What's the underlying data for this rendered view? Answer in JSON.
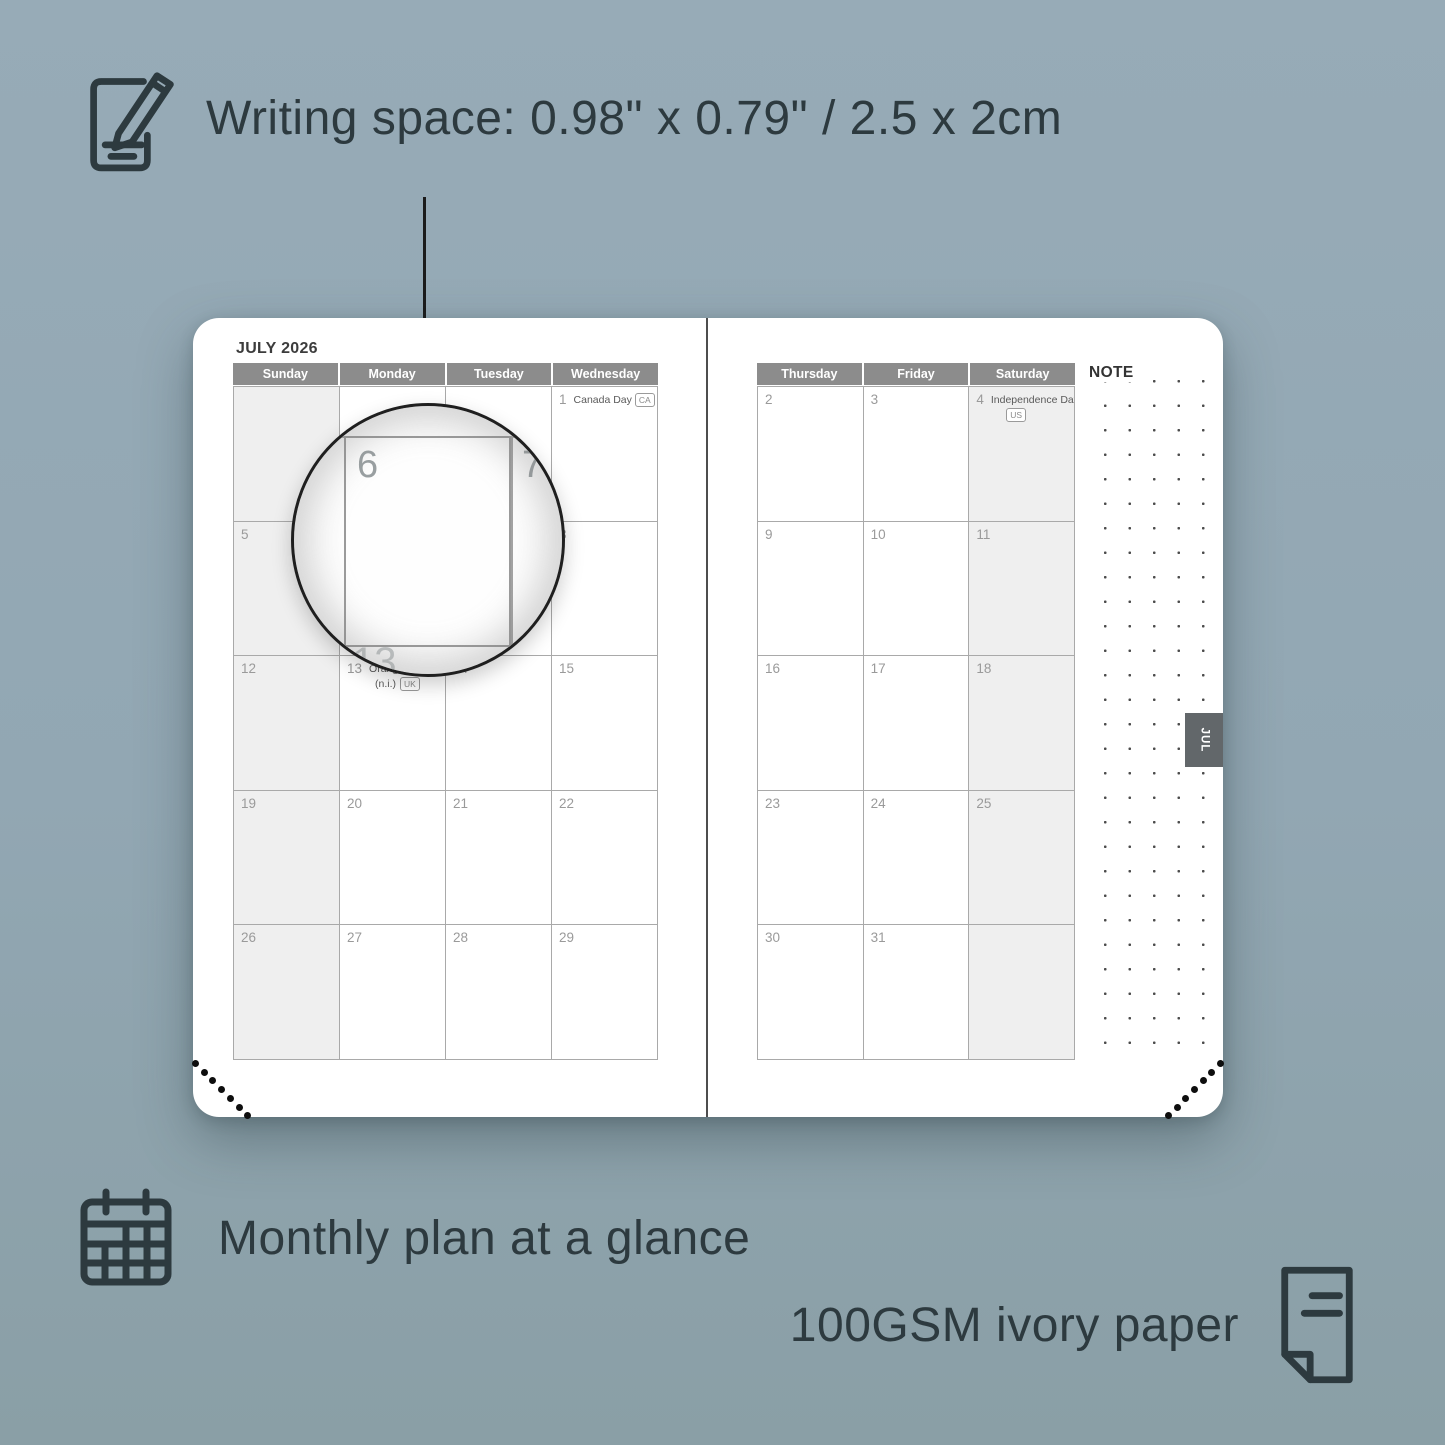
{
  "features": {
    "writing_space": {
      "label": "Writing space: 0.98\" x 0.79\" / 2.5 x 2cm",
      "icon": "pencil-note-icon"
    },
    "monthly_plan": {
      "label": "Monthly plan at a glance",
      "icon": "calendar-grid-icon"
    },
    "paper": {
      "label": "100GSM ivory paper",
      "icon": "page-icon"
    }
  },
  "planner": {
    "month_title": "JULY 2026",
    "tab_label": "JUL",
    "note_label": "NOTE",
    "magnifier": {
      "big_dates": [
        "6",
        "7",
        "13"
      ]
    },
    "left_page": {
      "day_headers": [
        "Sunday",
        "Monday",
        "Tuesday",
        "Wednesday"
      ],
      "shaded_columns": [
        0
      ],
      "weeks": [
        [
          {
            "date": ""
          },
          {
            "date": ""
          },
          {
            "date": ""
          },
          {
            "date": "1",
            "holiday": "Canada Day",
            "badge": "CA",
            "badge_inline": true
          }
        ],
        [
          {
            "date": "5"
          },
          {
            "date": "6"
          },
          {
            "date": "7"
          },
          {
            "date": "8"
          }
        ],
        [
          {
            "date": "12"
          },
          {
            "date": "13",
            "holiday": "Orangemen's Day",
            "line2": "(n.i.)",
            "badge": "UK"
          },
          {
            "date": "14"
          },
          {
            "date": "15"
          }
        ],
        [
          {
            "date": "19"
          },
          {
            "date": "20"
          },
          {
            "date": "21"
          },
          {
            "date": "22"
          }
        ],
        [
          {
            "date": "26"
          },
          {
            "date": "27"
          },
          {
            "date": "28"
          },
          {
            "date": "29"
          }
        ]
      ]
    },
    "right_page": {
      "day_headers": [
        "Thursday",
        "Friday",
        "Saturday"
      ],
      "shaded_columns": [
        2
      ],
      "weeks": [
        [
          {
            "date": "2"
          },
          {
            "date": "3"
          },
          {
            "date": "4",
            "holiday": "Independence Day",
            "badge": "US",
            "badge_below": true
          }
        ],
        [
          {
            "date": "9"
          },
          {
            "date": "10"
          },
          {
            "date": "11"
          }
        ],
        [
          {
            "date": "16"
          },
          {
            "date": "17"
          },
          {
            "date": "18"
          }
        ],
        [
          {
            "date": "23"
          },
          {
            "date": "24"
          },
          {
            "date": "25"
          }
        ],
        [
          {
            "date": "30"
          },
          {
            "date": "31"
          },
          {
            "date": ""
          }
        ]
      ]
    }
  },
  "colors": {
    "background": "#92a7b3",
    "text_dark": "#2d3a3f",
    "header_gray": "#8c8c8c",
    "shaded_cell": "#efefef",
    "grid_line": "#a9a9a9",
    "tab_gray": "#62676a",
    "page_white": "#ffffff"
  }
}
